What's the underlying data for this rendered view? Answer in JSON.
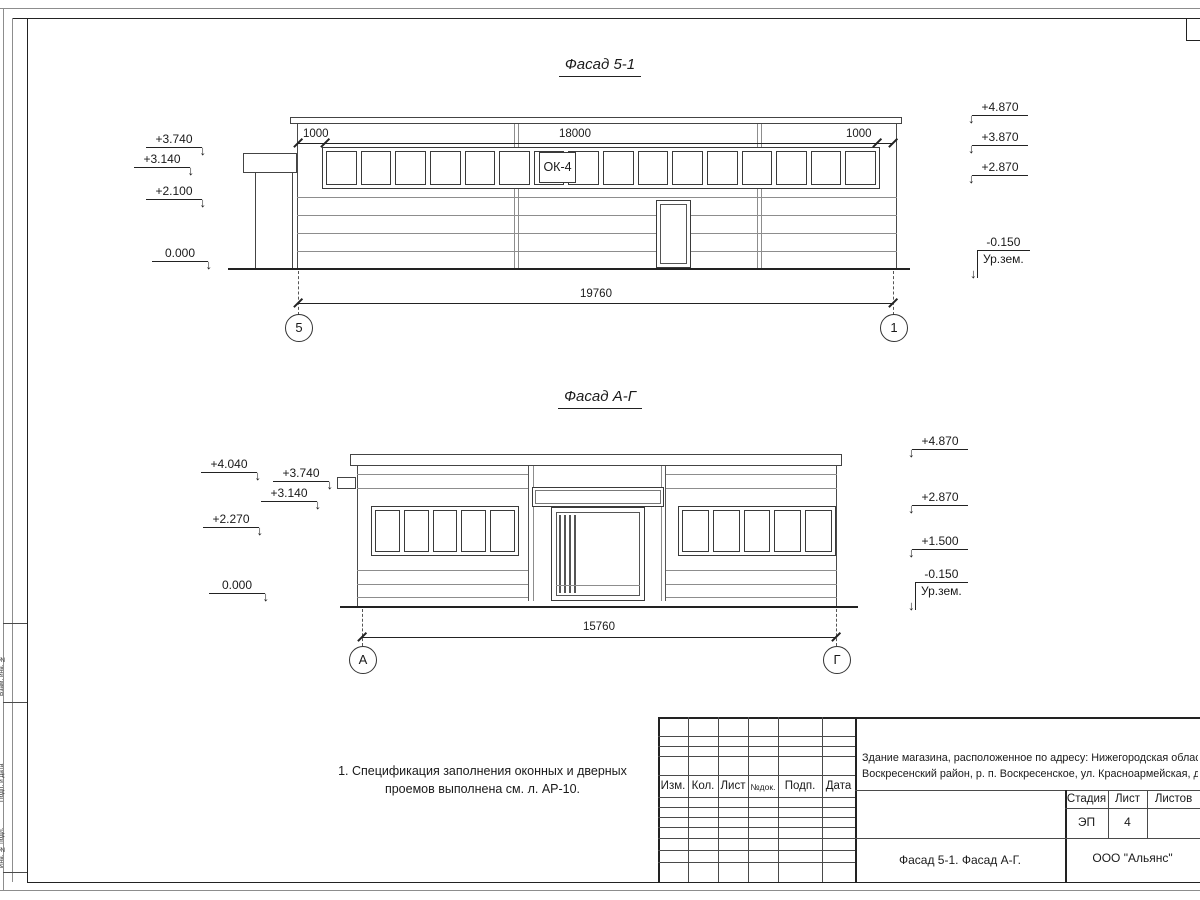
{
  "facade1": {
    "title": "Фасад 5-1",
    "window_label": "ОК-4",
    "dim_left": "1000",
    "dim_mid": "18000",
    "dim_right": "1000",
    "dim_total": "19760",
    "axis_left": "5",
    "axis_right": "1",
    "marks_left": [
      {
        "v": "+3.740"
      },
      {
        "v": "+3.140"
      },
      {
        "v": "+2.100"
      },
      {
        "v": "0.000"
      }
    ],
    "marks_right": [
      {
        "v": "+4.870"
      },
      {
        "v": "+3.870"
      },
      {
        "v": "+2.870"
      }
    ],
    "ground": {
      "v": "-0.150",
      "label": "Ур.зем."
    }
  },
  "facade2": {
    "title": "Фасад А-Г",
    "dim_total": "15760",
    "axis_left": "А",
    "axis_right": "Г",
    "marks_left": [
      {
        "v": "+4.040"
      },
      {
        "v": "+3.740"
      },
      {
        "v": "+3.140"
      },
      {
        "v": "+2.270"
      },
      {
        "v": "0.000"
      }
    ],
    "marks_right": [
      {
        "v": "+4.870"
      },
      {
        "v": "+2.870"
      },
      {
        "v": "+1.500"
      }
    ],
    "ground": {
      "v": "-0.150",
      "label": "Ур.зем."
    }
  },
  "note": {
    "line1": "1. Спецификация заполнения оконных и дверных",
    "line2": "проемов выполнена см. л. АР-10."
  },
  "titleblock": {
    "col_izm": "Изм.",
    "col_kol": "Кол.",
    "col_list": "Лист",
    "col_ndok": "№док.",
    "col_podp": "Подп.",
    "col_data": "Дата",
    "address_line1": "Здание магазина, расположенное по адресу: Нижегородская область,",
    "address_line2": "Воскресенский район, р. п. Воскресенское, ул. Красноармейская, д. 1",
    "stage_label": "Стадия",
    "sheet_label": "Лист",
    "sheets_label": "Листов",
    "stage_value": "ЭП",
    "sheet_value": "4",
    "doc_title": "Фасад 5-1. Фасад А-Г.",
    "company": "ООО \"Альянс\""
  },
  "margin": {
    "label1": "Взам. инв. №",
    "label2": "Подп. и дата",
    "label3": "Инв. № подл."
  }
}
